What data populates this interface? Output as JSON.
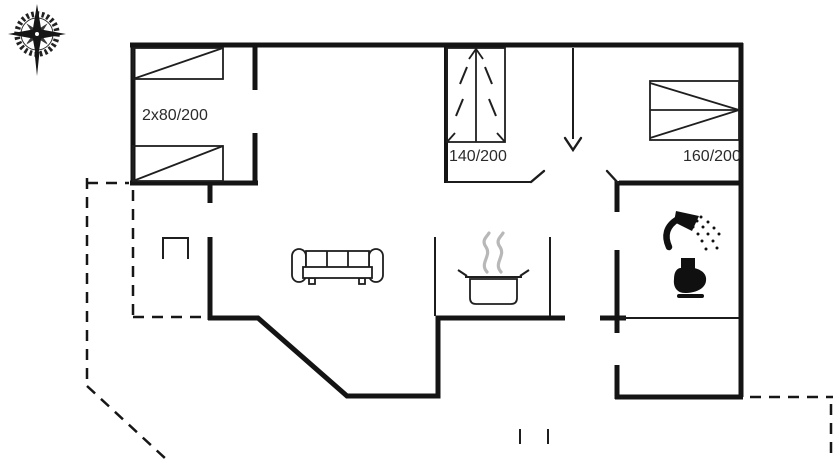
{
  "plan": {
    "title": "holiday-house-floor-plan",
    "labels": {
      "bedroom_nw_bed": "2x80/200",
      "bedroom_mid_bed": "140/200",
      "bedroom_ne_bed": "160/200"
    },
    "colors": {
      "wall": "#141414",
      "line": "#1c1c1c",
      "steam": "#b8b8b8",
      "label_text": "#2b2b2b",
      "background": "#ffffff"
    },
    "icons": {
      "compass-rose-icon": "svg-star-with-gear-ring",
      "single-bed-icon": "svg-rect-with-diagonal",
      "double-bed-140-icon": "svg-rect-center-line-arrows",
      "double-bed-160-icon": "svg-rect-twin-triangles",
      "sofa-icon": "svg-three-seat-sofa-outline",
      "cooking-pot-icon": "svg-pot-with-steam",
      "shower-icon": "svg-black-shower-head-spray",
      "toilet-icon": "svg-black-toilet-silhouette",
      "washbasin-icon": "svg-open-rectangle",
      "step-marks-icon": "svg-two-ticks"
    }
  }
}
